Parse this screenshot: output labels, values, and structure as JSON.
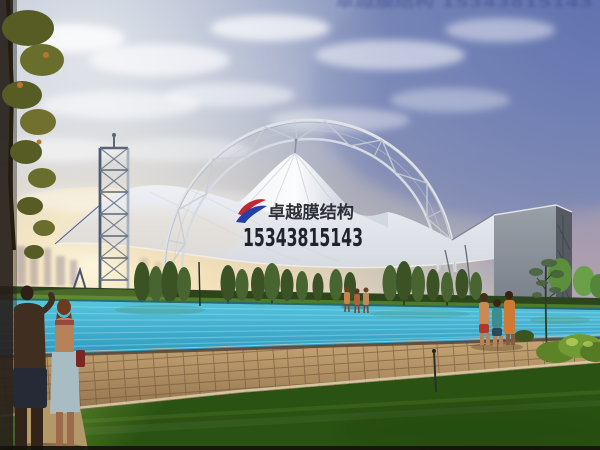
{
  "meta": {
    "title": "Membrane structure pool canopy rendering",
    "description": "Architectural rendering: arched steel-truss tensile membrane canopy over an outdoor swimming pool at dusk, watermarked by a membrane-structure company."
  },
  "watermark": {
    "brand": "卓越膜结构",
    "phone": "15343815143",
    "top_edge_text": "卓越膜结构 15343815143"
  },
  "scene": {
    "structure": "white tensile membrane canopy with central cone peak under an arched lattice steel truss",
    "left_structure": "lattice steel mast tower",
    "right_structure": "grey side wall panel with lattice frame",
    "water": "turquoise swimming pool",
    "ground": "herringbone tile pool deck and green lawn",
    "vegetation": "row of poplar trees on horizon, sapling and shrubs at right, tree at top-left edge",
    "people": "couple in foreground left, three bathers at far pool edge, three bathers on right deck",
    "lighting": "sunset glow low left, blue-purple sky upper right, scattered clouds"
  },
  "palette": {
    "sky_top": "#a3aec8",
    "sky_blue_corner": "#4f63a8",
    "sunset_core": "#fffbe9",
    "sunset_warm": "#f6dfb2",
    "horizon_warm": "#f4e7c6",
    "membrane_light": "#f8f9fb",
    "membrane_shade": "#d6dae2",
    "truss_light": "#dfe2e8",
    "tower_dark": "#4e5a6e",
    "tower_light": "#aab2c0",
    "wall_front_top": "#9aa0a8",
    "wall_front_bottom": "#6f757e",
    "wall_side": "#565b63",
    "tree_green_a": "#3a5224",
    "tree_green_b": "#486430",
    "hedge_green": "#2c451c",
    "pool_light": "#58c6de",
    "pool_deep": "#2d97bd",
    "ripple": "#9fe2ef",
    "deck_light": "#caa878",
    "deck_dark": "#8d6f48",
    "deck_joint": "#6e5438",
    "lawn_light": "#7aa63c",
    "lawn_dark": "#2a5212",
    "curb": "#d9cba8",
    "watermark_text": "#1b1b24",
    "logo_red": "#c22733",
    "logo_blue": "#2340a8",
    "bottom_strip": "#14120c"
  }
}
